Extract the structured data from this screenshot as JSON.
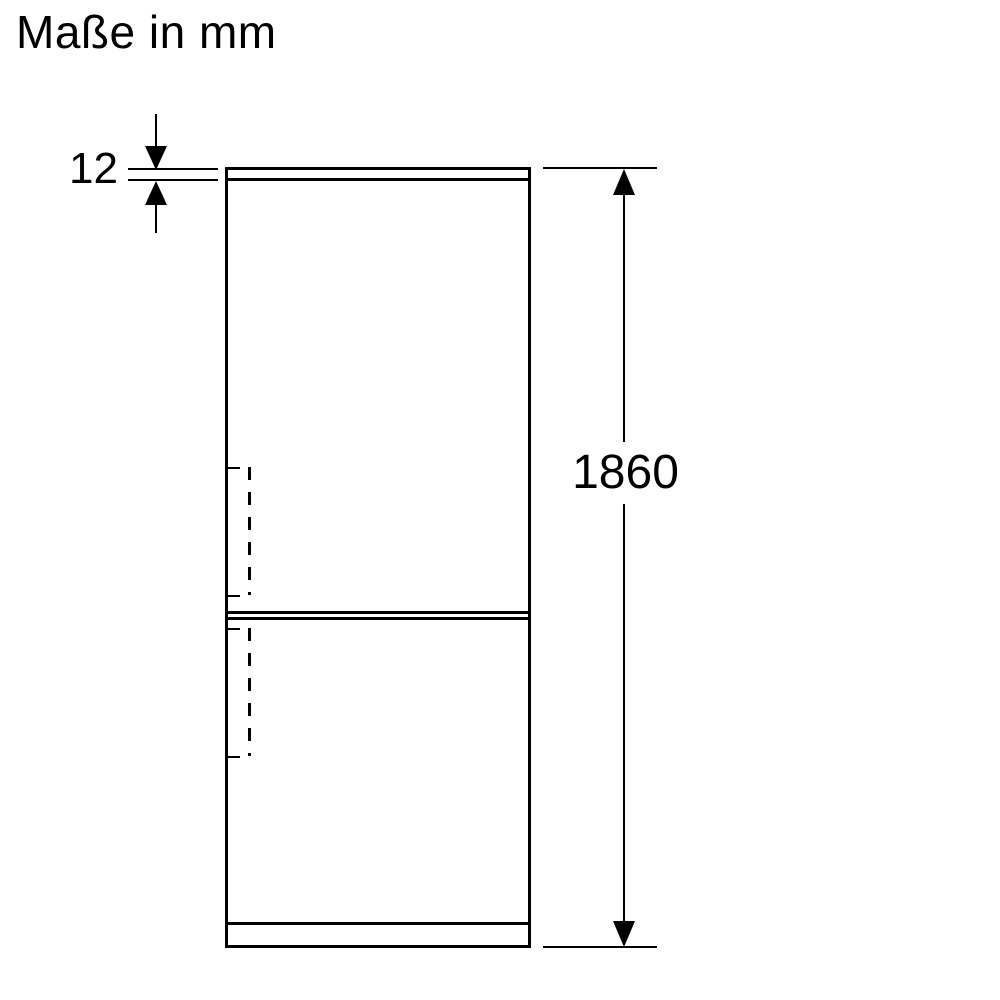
{
  "header": {
    "title": "Maße in mm"
  },
  "colors": {
    "ink": "#000000",
    "background": "#ffffff"
  },
  "icons": {
    "dimension_arrowheads": [
      "arrow-up-icon",
      "arrow-down-icon"
    ]
  },
  "diagram": {
    "dimensions": [
      {
        "id": "top-gap",
        "value": "12"
      },
      {
        "id": "overall-height",
        "value": "1860"
      }
    ]
  }
}
